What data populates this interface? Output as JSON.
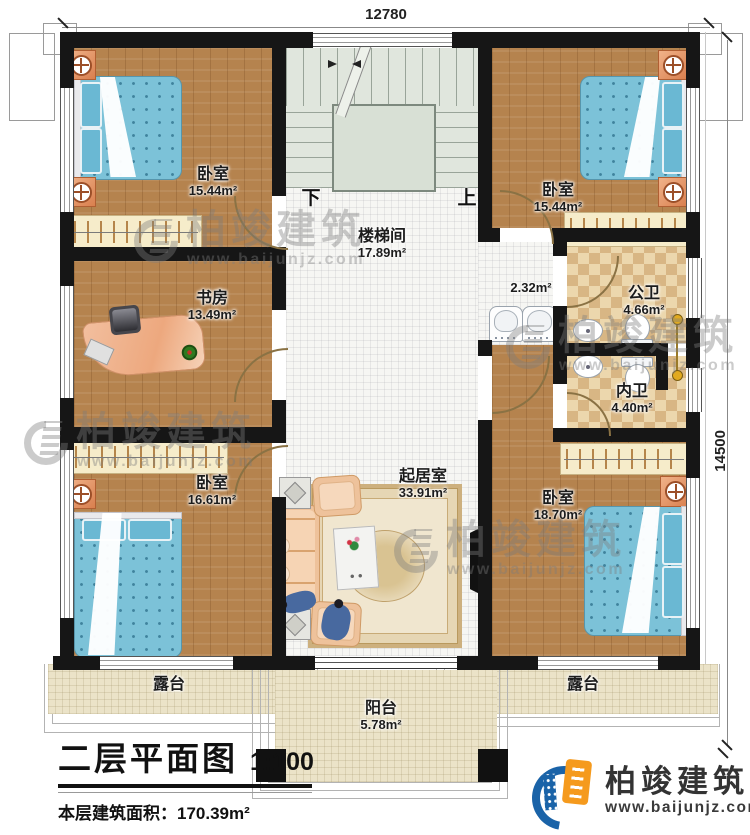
{
  "plan": {
    "title": "二层平面图",
    "scale": "1:100",
    "area_line": "本层建筑面积：170.39m²",
    "height_line": "层高：3.4m"
  },
  "dimensions": {
    "top": "12780",
    "right": "14500"
  },
  "stairs": {
    "down": "下",
    "up": "上"
  },
  "rooms": {
    "bedroom_tl": {
      "name": "卧室",
      "area": "15.44m²"
    },
    "bedroom_tr": {
      "name": "卧室",
      "area": "15.44m²"
    },
    "stairwell": {
      "name": "楼梯间",
      "area": "17.89m²"
    },
    "study": {
      "name": "书房",
      "area": "13.49m²"
    },
    "vestibule": {
      "area": "2.32m²"
    },
    "public_bath": {
      "name": "公卫",
      "area": "4.66m²"
    },
    "inner_bath": {
      "name": "内卫",
      "area": "4.40m²"
    },
    "bedroom_bl": {
      "name": "卧室",
      "area": "16.61m²"
    },
    "living": {
      "name": "起居室",
      "area": "33.91m²"
    },
    "bedroom_br": {
      "name": "卧室",
      "area": "18.70m²"
    },
    "terrace_left": {
      "name": "露台"
    },
    "terrace_right": {
      "name": "露台"
    },
    "balcony": {
      "name": "阳台",
      "area": "5.78m²"
    }
  },
  "watermark": {
    "brand": "柏竣建筑",
    "url": "www.baijunjz.com"
  },
  "logo": {
    "brand": "柏竣建筑",
    "url": "www.baijunjz.com"
  },
  "colors": {
    "wall": "#161616",
    "wood_floor": "#b5834e",
    "bed_blue": "#7cc2d8",
    "bath_tile": "#ecd7ad",
    "stair": "#e0e6dd",
    "terrace": "#ebe3c8",
    "brand_blue": "#1a63a8",
    "brand_orange": "#f59a1d"
  }
}
